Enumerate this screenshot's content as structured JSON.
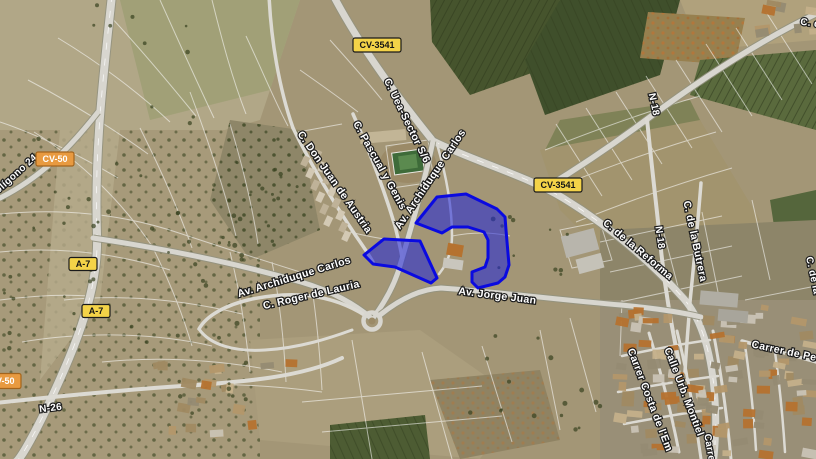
{
  "map": {
    "type": "satellite-map-with-highlighted-parcels",
    "highlight": {
      "fill": "#1f25d8",
      "fill_opacity": 0.55,
      "stroke": "#0a0ae0",
      "stroke_width": 3
    },
    "route_badges": [
      {
        "label": "CV-3541",
        "x": 377,
        "y": 45,
        "w": 48,
        "h": 14,
        "bg": "#f4d348",
        "fg": "#151515",
        "border": "#1a1a1a"
      },
      {
        "label": "CV-3541",
        "x": 558,
        "y": 185,
        "w": 48,
        "h": 14,
        "bg": "#f4d348",
        "fg": "#151515",
        "border": "#1a1a1a"
      },
      {
        "label": "CV-50",
        "x": 55,
        "y": 159,
        "w": 38,
        "h": 14,
        "bg": "#e89a40",
        "fg": "#ffffff",
        "border": "#a3641c"
      },
      {
        "label": "CV-50",
        "x": 2,
        "y": 381,
        "w": 38,
        "h": 15,
        "bg": "#e89a40",
        "fg": "#ffffff",
        "border": "#a3641c"
      },
      {
        "label": "A-7",
        "x": 83,
        "y": 264,
        "w": 28,
        "h": 13,
        "bg": "#f4d348",
        "fg": "#151515",
        "border": "#1a1a1a"
      },
      {
        "label": "A-7",
        "x": 96,
        "y": 311,
        "w": 28,
        "h": 13,
        "bg": "#f4d348",
        "fg": "#151515",
        "border": "#1a1a1a"
      }
    ],
    "road_labels": [
      {
        "text": "C. Uea-Sector S/6",
        "x": 404,
        "y": 122,
        "rot": 64,
        "size": 10.5
      },
      {
        "text": "C. Pascual y Genis",
        "x": 377,
        "y": 167,
        "rot": 61,
        "size": 10.5
      },
      {
        "text": "C. Don Juan de Austria",
        "x": 332,
        "y": 184,
        "rot": 55,
        "size": 10.5
      },
      {
        "text": "Av. Archiduque Carlos",
        "x": 433,
        "y": 181,
        "rot": -56,
        "size": 10.5
      },
      {
        "text": "Av. Archiduque Carlos",
        "x": 295,
        "y": 280,
        "rot": -17,
        "size": 10.5
      },
      {
        "text": "C. Roger de Lauria",
        "x": 312,
        "y": 298,
        "rot": -13,
        "size": 10.5
      },
      {
        "text": "Av. Jorge Juan",
        "x": 497,
        "y": 299,
        "rot": 7,
        "size": 10.5
      },
      {
        "text": "C. de la Reforma",
        "x": 636,
        "y": 252,
        "rot": 40,
        "size": 10.5
      },
      {
        "text": "N-18",
        "x": 651,
        "y": 105,
        "rot": 78,
        "size": 10
      },
      {
        "text": "N-18",
        "x": 657,
        "y": 238,
        "rot": 82,
        "size": 10
      },
      {
        "text": "C. de la Butrera",
        "x": 692,
        "y": 242,
        "rot": 78,
        "size": 10.5
      },
      {
        "text": "N-26",
        "x": 51,
        "y": 411,
        "rot": -7,
        "size": 10
      },
      {
        "text": "Carrer de Pedro",
        "x": 792,
        "y": 356,
        "rot": 12,
        "size": 10.5
      },
      {
        "text": "Calle Urb. Montiel",
        "x": 681,
        "y": 393,
        "rot": 69,
        "size": 10.5
      },
      {
        "text": "Carrer Costa de l'Em",
        "x": 647,
        "y": 401,
        "rot": 69,
        "size": 10.5
      },
      {
        "text": "Carrer",
        "x": 707,
        "y": 450,
        "rot": 80,
        "size": 10
      },
      {
        "text": "C. de la",
        "x": 810,
        "y": 276,
        "rot": 78,
        "size": 10
      },
      {
        "text": "olígono 24",
        "x": 18,
        "y": 176,
        "rot": -42,
        "size": 10
      },
      {
        "text": "C. d",
        "x": 810,
        "y": 26,
        "rot": 8,
        "size": 10
      }
    ],
    "highlighted_parcels": [
      {
        "name": "parcel-west",
        "points": "364,255 384,239 420,241 437,278 431,283 395,267 373,264"
      },
      {
        "name": "parcel-east",
        "points": "416,223 437,197 466,194 497,209 505,217 506,230 509,265 505,277 498,283 478,288 472,282 472,272 485,267 488,258 488,240 484,232 468,227 452,227 442,233"
      }
    ]
  }
}
